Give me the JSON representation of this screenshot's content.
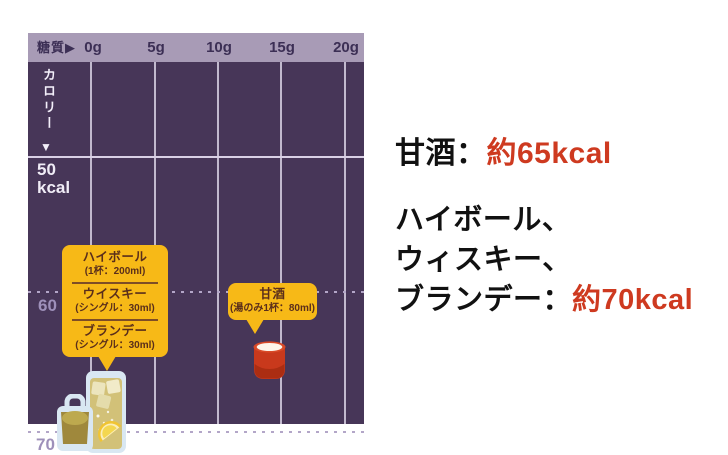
{
  "chart": {
    "x_axis_title": "糖質",
    "x_axis_arrow": "▶",
    "x_ticks": [
      "0g",
      "5g",
      "10g",
      "15g",
      "20g"
    ],
    "y_axis_title": "カロリー",
    "y_axis_arrow": "▼",
    "y_label_50": "50",
    "y_label_50_unit": "kcal",
    "y_label_60": "60",
    "y_label_70": "70",
    "callout_alcohol": {
      "items": [
        {
          "name": "ハイボール",
          "serving": "(1杯：200ml)"
        },
        {
          "name": "ウイスキー",
          "serving": "(シングル：30ml)"
        },
        {
          "name": "ブランデー",
          "serving": "(シングル：30ml)"
        }
      ]
    },
    "callout_amazake": {
      "name": "甘酒",
      "serving": "(湯のみ1杯：80ml)"
    },
    "icons": [
      "highball-glass",
      "whisky-glass",
      "amazake-cup"
    ]
  },
  "annotations": {
    "line1_label": "甘酒：",
    "line1_value": "約65kcal",
    "line2a": "ハイボール、",
    "line2b": "ウィスキー、",
    "line3_label": "ブランデー：",
    "line3_value": "約70kcal"
  },
  "colors": {
    "chart_body": "#473658",
    "chart_header": "#a89bb6",
    "header_text": "#3c2f55",
    "callout_yellow": "#f7b917",
    "callout_text": "#5a2e1b",
    "accent_red": "#ce3a20",
    "amazake_cup_red": "#c9391c",
    "text_black": "#111111",
    "background": "#ffffff"
  },
  "chart_data": {
    "type": "scatter",
    "xlabel": "糖質",
    "ylabel": "カロリー",
    "x_ticks": [
      "0g",
      "5g",
      "10g",
      "15g",
      "20g"
    ],
    "y_ticks": [
      50,
      60,
      70
    ],
    "y_unit": "kcal",
    "x_range": [
      0,
      20
    ],
    "grid": true,
    "points": [
      {
        "name": "甘酒",
        "serving": "湯のみ1杯：80ml",
        "sugar_g": 14,
        "kcal": 65
      },
      {
        "name": "ハイボール",
        "serving": "1杯：200ml",
        "sugar_g": 0,
        "kcal": 70
      },
      {
        "name": "ウイスキー",
        "serving": "シングル：30ml",
        "sugar_g": 0,
        "kcal": 70
      },
      {
        "name": "ブランデー",
        "serving": "シングル：30ml",
        "sugar_g": 0,
        "kcal": 70
      }
    ]
  }
}
